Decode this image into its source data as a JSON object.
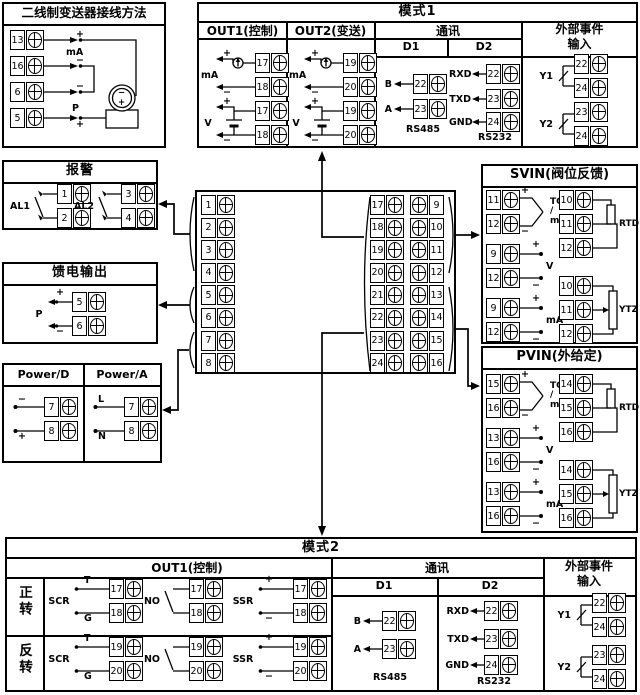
{
  "transmitter": {
    "title": "二线制变送器接线方法",
    "t": [
      "13",
      "16",
      "6",
      "5"
    ],
    "plus_top": "+",
    "ma": "mA",
    "minus_mid": "−",
    "minus_low": "−",
    "p": "P",
    "plus_bot": "+",
    "tx_minus": "−",
    "tx_plus": "+"
  },
  "mode1": {
    "title": "模式1",
    "out1": {
      "header": "OUT1(控制)",
      "ma": {
        "label": "mA",
        "plus": "+",
        "minus": "−",
        "t": [
          "17",
          "18"
        ]
      },
      "v": {
        "label": "V",
        "plus": "+",
        "minus": "−",
        "t": [
          "17",
          "18"
        ]
      }
    },
    "out2": {
      "header": "OUT2(变送)",
      "ma": {
        "label": "mA",
        "plus": "+",
        "minus": "−",
        "t": [
          "19",
          "20"
        ]
      },
      "v": {
        "label": "V",
        "plus": "+",
        "minus": "−",
        "t": [
          "19",
          "20"
        ]
      }
    },
    "comm": {
      "header": "通讯",
      "d1": {
        "header": "D1",
        "rows": [
          {
            "label": "B",
            "t": "22"
          },
          {
            "label": "A",
            "t": "23"
          }
        ],
        "bus": "RS485"
      },
      "d2": {
        "header": "D2",
        "rows": [
          {
            "label": "RXD",
            "t": "22"
          },
          {
            "label": "TXD",
            "t": "23"
          },
          {
            "label": "GND",
            "t": "24"
          }
        ],
        "bus": "RS232"
      }
    },
    "event": {
      "header": "外部事件输入",
      "y1": {
        "label": "Y1",
        "t": [
          "22",
          "24"
        ]
      },
      "y2": {
        "label": "Y2",
        "t": [
          "23",
          "24"
        ]
      }
    }
  },
  "alarm": {
    "title": "报警",
    "al1": {
      "label": "AL1",
      "t": [
        "1",
        "2"
      ]
    },
    "al2": {
      "label": "AL2",
      "t": [
        "3",
        "4"
      ]
    }
  },
  "feed": {
    "title": "馈电输出",
    "label": "P",
    "plus": "+",
    "minus": "−",
    "t": [
      "5",
      "6"
    ]
  },
  "power": {
    "d": {
      "header": "Power/D",
      "top_label": "−",
      "bot_label": "+",
      "t": [
        "7",
        "8"
      ]
    },
    "a": {
      "header": "Power/A",
      "top_label": "L",
      "bot_label": "N",
      "t": [
        "7",
        "8"
      ]
    }
  },
  "center": {
    "left": [
      "1",
      "2",
      "3",
      "4",
      "5",
      "6",
      "7",
      "8"
    ],
    "mid": [
      "17",
      "18",
      "19",
      "20",
      "21",
      "22",
      "23",
      "24"
    ],
    "right": [
      "9",
      "10",
      "11",
      "12",
      "13",
      "14",
      "15",
      "16"
    ]
  },
  "svin": {
    "title": "SVIN(阀位反馈)",
    "tc": {
      "plus": "+",
      "minus": "−",
      "l1": "TC",
      "l2": "/",
      "l3": "mV",
      "t": [
        "11",
        "12"
      ]
    },
    "v": {
      "plus": "+",
      "minus": "−",
      "label": "V",
      "t": [
        "9",
        "12"
      ]
    },
    "ma": {
      "plus": "+",
      "minus": "−",
      "label": "mA",
      "t": [
        "9",
        "12"
      ]
    },
    "rtd": {
      "label": "RTD",
      "t": [
        "10",
        "11",
        "12"
      ]
    },
    "ytz": {
      "label": "YTZ",
      "t": [
        "10",
        "11",
        "12"
      ]
    }
  },
  "pvin": {
    "title": "PVIN(外给定)",
    "tc": {
      "plus": "+",
      "minus": "−",
      "l1": "TC",
      "l2": "/",
      "l3": "mV",
      "t": [
        "15",
        "16"
      ]
    },
    "v": {
      "plus": "+",
      "minus": "−",
      "label": "V",
      "t": [
        "13",
        "16"
      ]
    },
    "ma": {
      "plus": "+",
      "minus": "−",
      "label": "mA",
      "t": [
        "13",
        "16"
      ]
    },
    "rtd": {
      "label": "RTD",
      "t": [
        "14",
        "15",
        "16"
      ]
    },
    "ytz": {
      "label": "YTZ",
      "t": [
        "14",
        "15",
        "16"
      ]
    }
  },
  "mode2": {
    "title": "模式2",
    "out1_header": "OUT1(控制)",
    "comm_header": "通讯",
    "event_header": "外部事件输入",
    "row1": {
      "label": "正转",
      "scr": {
        "label": "SCR",
        "t_label": "T",
        "g_label": "G",
        "t": [
          "17",
          "18"
        ]
      },
      "no": {
        "label": "NO",
        "t": [
          "17",
          "18"
        ]
      },
      "ssr": {
        "label": "SSR",
        "plus": "+",
        "minus": "−",
        "t": [
          "17",
          "18"
        ]
      }
    },
    "row2": {
      "label": "反转",
      "scr": {
        "label": "SCR",
        "t_label": "T",
        "g_label": "G",
        "t": [
          "19",
          "20"
        ]
      },
      "no": {
        "label": "NO",
        "t": [
          "19",
          "20"
        ]
      },
      "ssr": {
        "label": "SSR",
        "plus": "+",
        "minus": "−",
        "t": [
          "19",
          "20"
        ]
      }
    },
    "d1": {
      "header": "D1",
      "rows": [
        {
          "label": "B",
          "t": "22"
        },
        {
          "label": "A",
          "t": "23"
        }
      ],
      "bus": "RS485"
    },
    "d2": {
      "header": "D2",
      "rows": [
        {
          "label": "RXD",
          "t": "22"
        },
        {
          "label": "TXD",
          "t": "23"
        },
        {
          "label": "GND",
          "t": "24"
        }
      ],
      "bus": "RS232"
    },
    "event": {
      "y1": {
        "label": "Y1",
        "t": [
          "22",
          "24"
        ]
      },
      "y2": {
        "label": "Y2",
        "t": [
          "23",
          "24"
        ]
      }
    }
  }
}
